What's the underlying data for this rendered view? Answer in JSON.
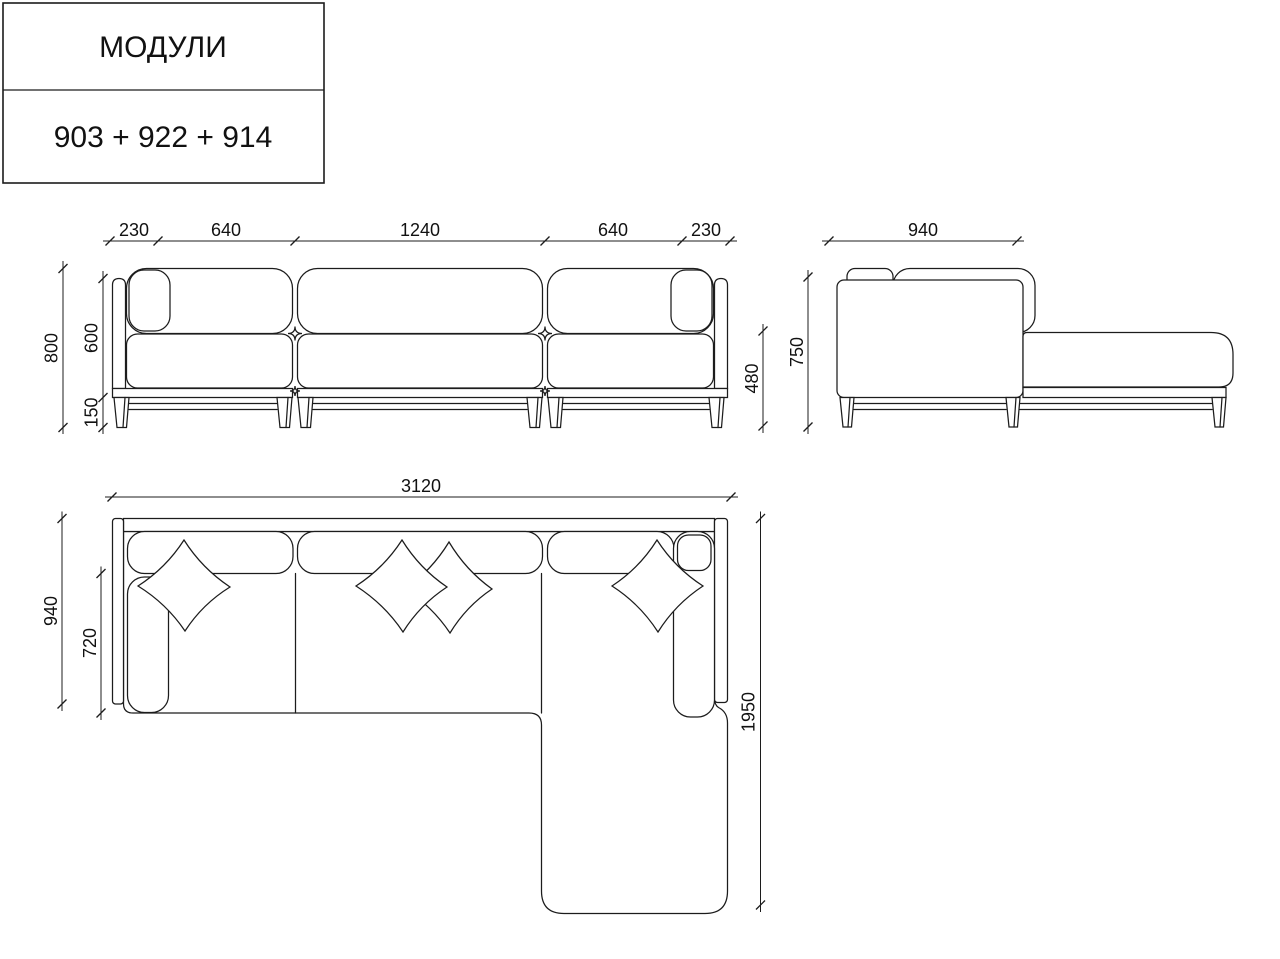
{
  "title_block": {
    "title": "МОДУЛИ",
    "modules_code": "903 + 922 + 914"
  },
  "colors": {
    "line": "#1c1c1c",
    "background": "#ffffff"
  },
  "front_view": {
    "top_dims": [
      "230",
      "640",
      "1240",
      "640",
      "230"
    ],
    "total_height": "800",
    "back_height": "600",
    "leg_height": "150",
    "seat_height": "480"
  },
  "side_view": {
    "depth": "940",
    "total_height": "750"
  },
  "plan_view": {
    "total_width": "3120",
    "total_depth": "940",
    "seat_depth": "720",
    "chaise_length": "1950"
  }
}
